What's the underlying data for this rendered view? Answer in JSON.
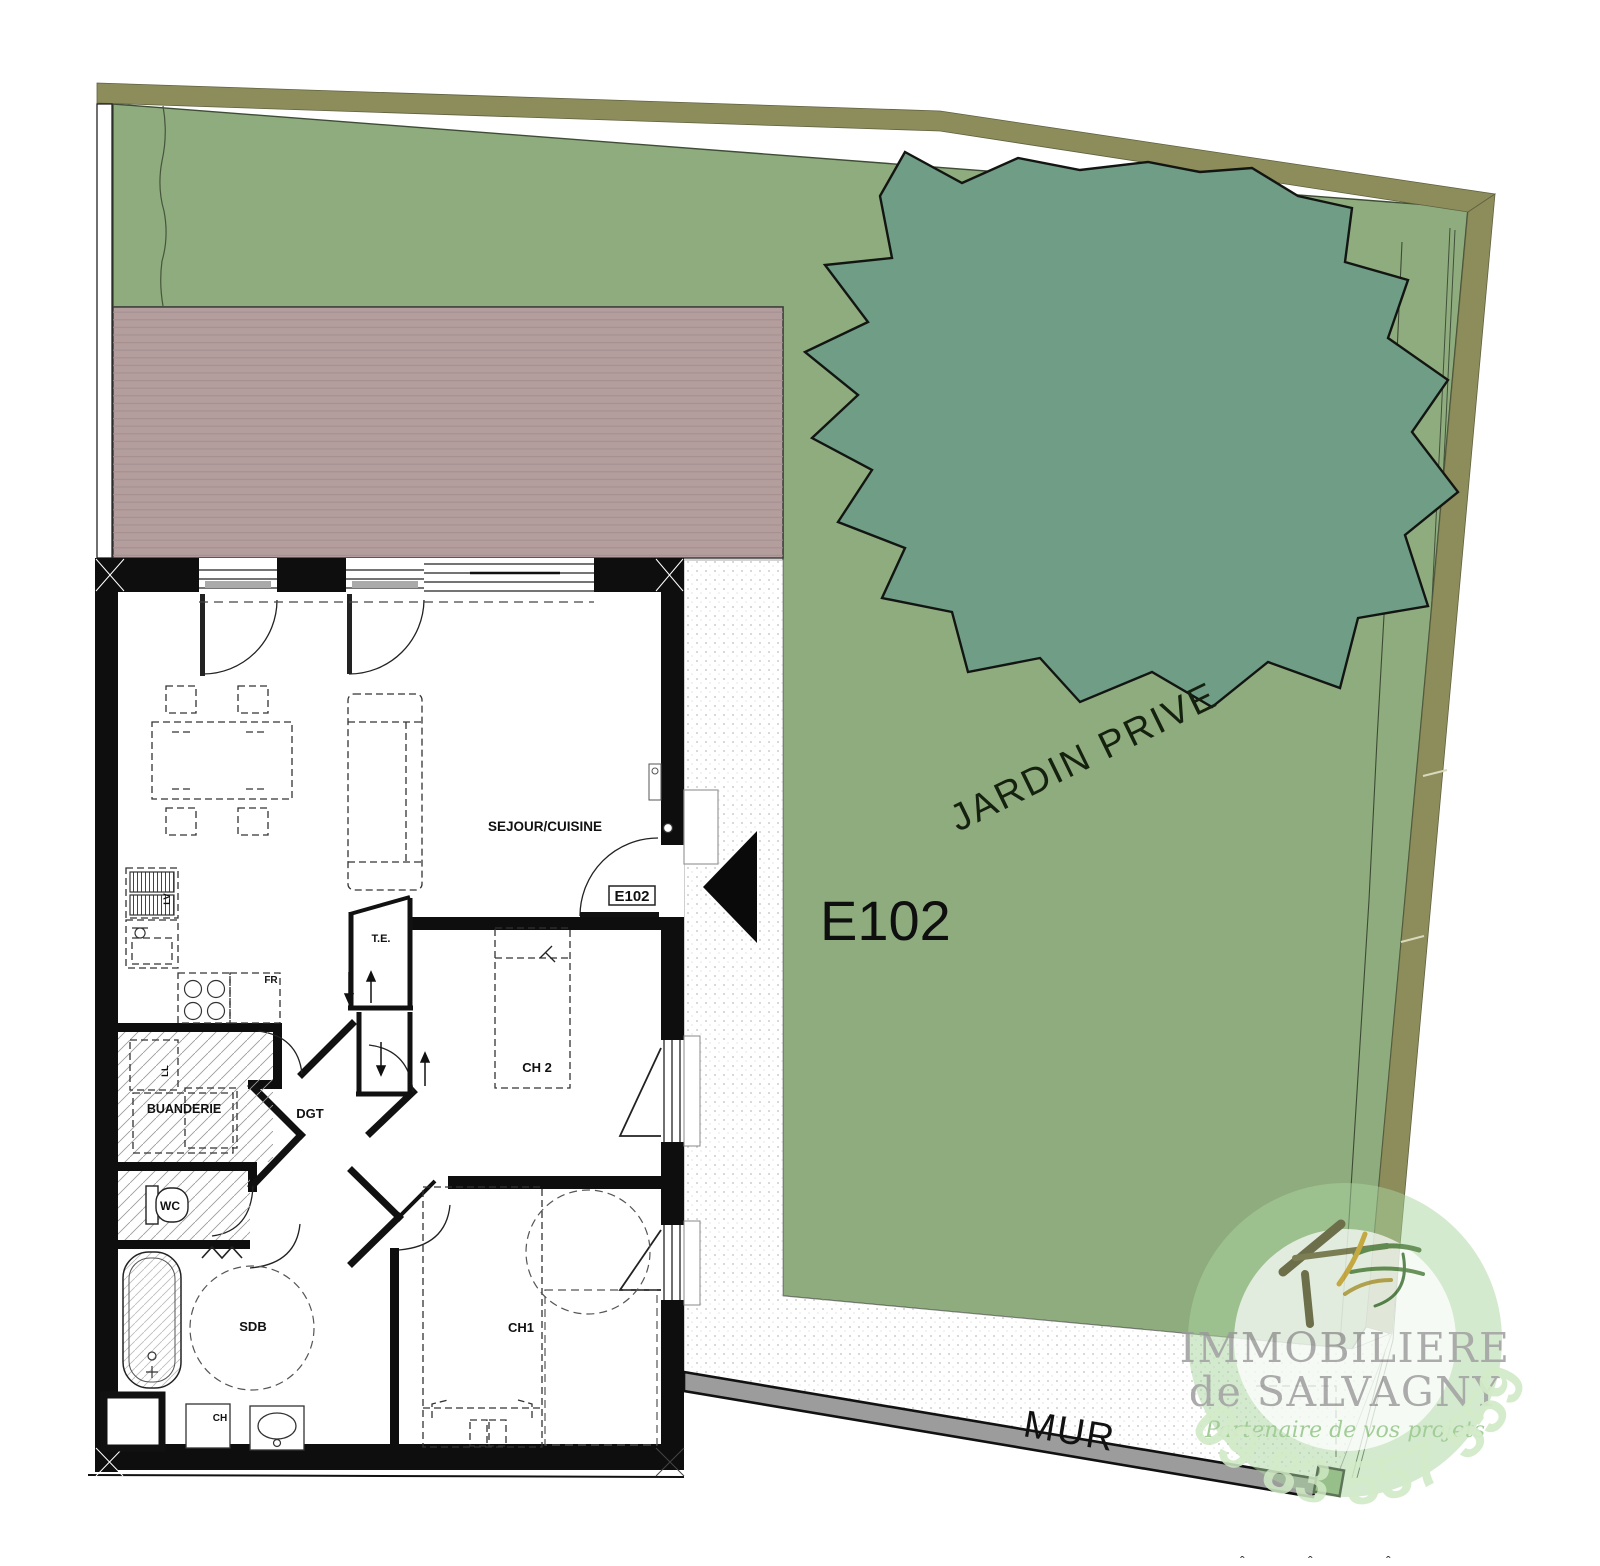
{
  "plan": {
    "door_tag": "E102",
    "garden_unit_label": "E102",
    "garden_area_label": "JARDIN PRIVE",
    "wall_label": "MUR",
    "rooms": {
      "sejour": "SEJOUR/CUISINE",
      "buanderie": "BUANDERIE",
      "degagement": "DGT",
      "wc": "WC",
      "sdb": "SDB",
      "ch1": "CH1",
      "ch2": "CH 2",
      "te": "T.E."
    },
    "appliances": {
      "fridge": "FR",
      "dishwasher": "LV",
      "washer": "LL",
      "water_heater": "CH"
    }
  },
  "watermark": {
    "company_line1": "IMMOBILIERE",
    "company_line2": "de SALVAGNY",
    "tagline": "Partenaire de vos projets",
    "phone": "09 83 557 559"
  },
  "colors": {
    "garden": "#8FAC7E",
    "tree": "#6F9D85",
    "boundary_band": "#8C8D5B",
    "terrace": "#B49D9D",
    "terrace_line": "#A38F8F",
    "path_dot": "#BDBDBD",
    "mur_gray": "#9C9C9C",
    "wall_black": "#0E0E0E",
    "logo_ring": "#A9D69E",
    "logo_text_gray": "#9B9B9B",
    "logo_script_green": "#9CC98F",
    "logo_phone_green": "#CFE9C4"
  },
  "edge_marks": {
    "m1": "ˆ",
    "m2": "ˆ",
    "m3": "ˆ"
  }
}
